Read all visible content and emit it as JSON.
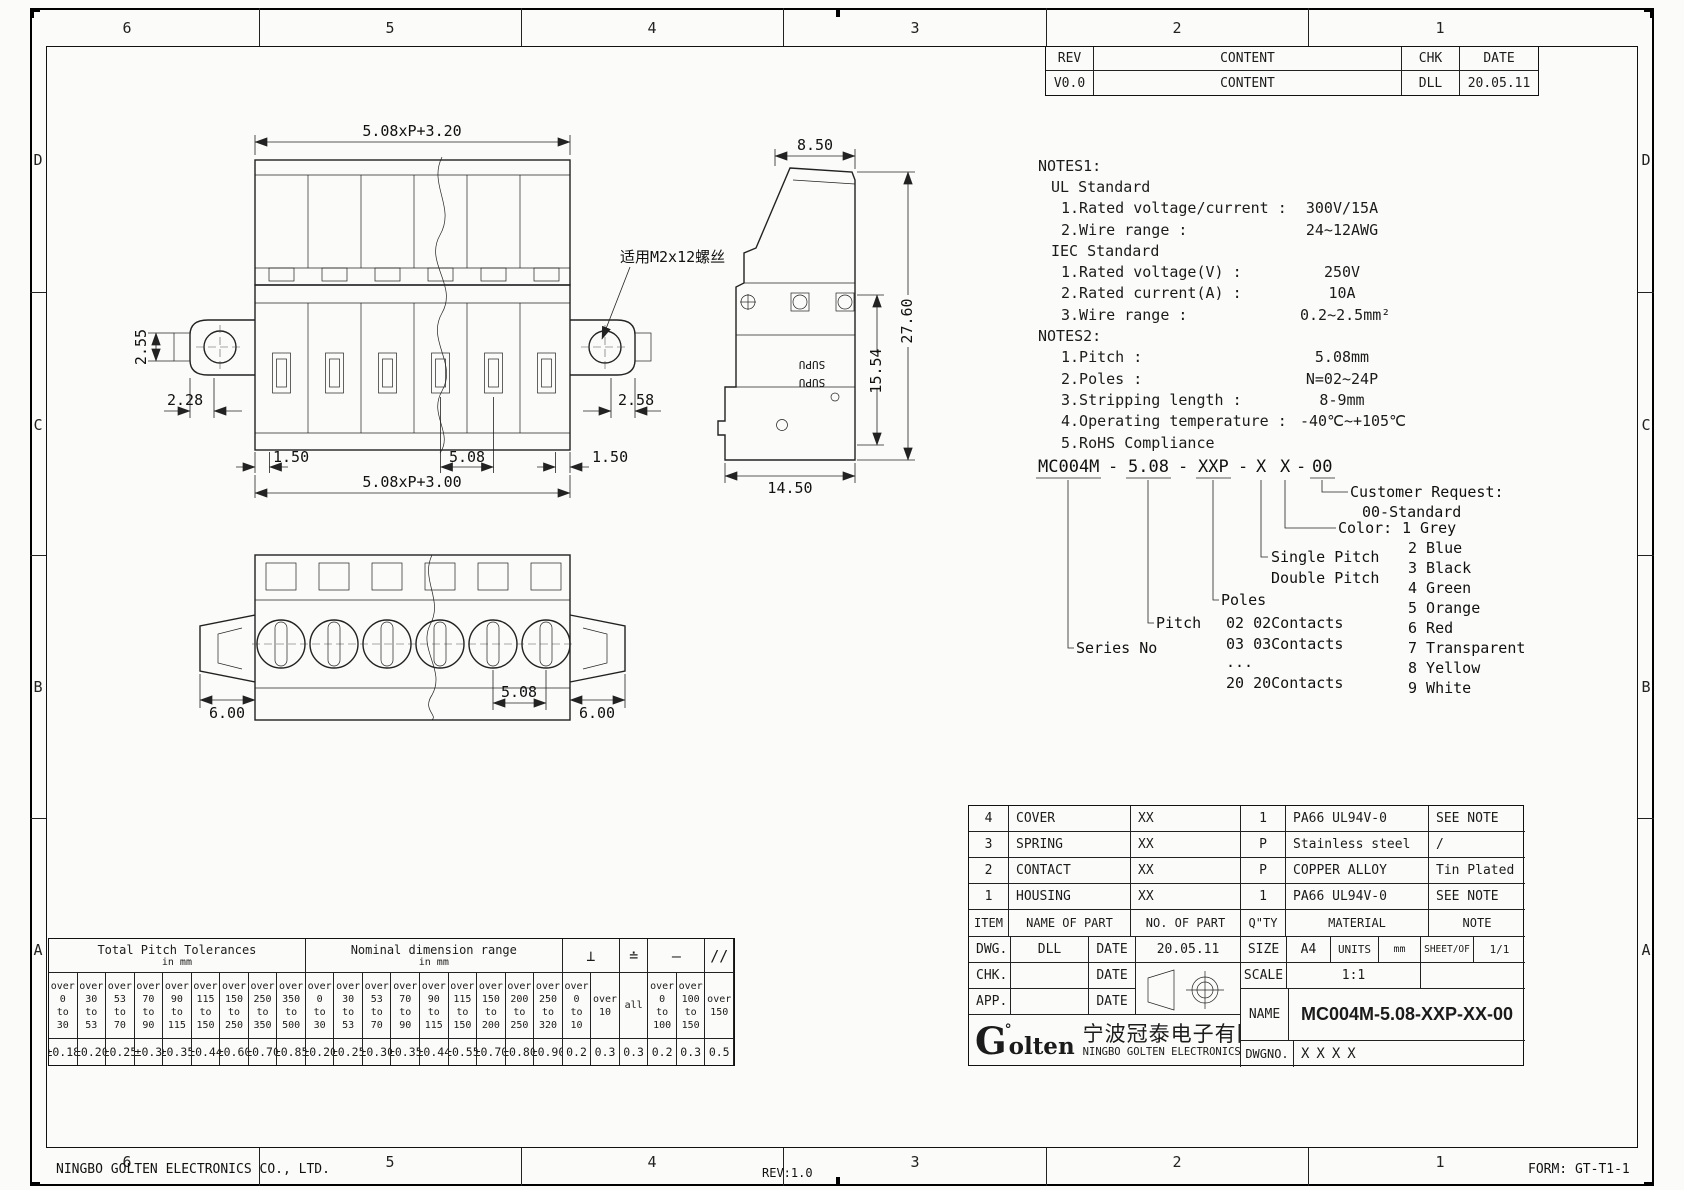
{
  "sheet": {
    "zones_cols": [
      "6",
      "5",
      "4",
      "3",
      "2",
      "1"
    ],
    "zones_rows": [
      "D",
      "C",
      "B",
      "A"
    ],
    "footer_company": "NINGBO GOLTEN ELECTRONICS CO., LTD.",
    "footer_rev": "REV:1.0",
    "footer_form": "FORM: GT-T1-1"
  },
  "revision_table": {
    "col_rev": "REV",
    "col_content": "CONTENT",
    "col_chk": "CHK",
    "col_date": "DATE",
    "row_rev": "V0.0",
    "row_content": "CONTENT",
    "row_chk": "DLL",
    "row_date": "20.05.11"
  },
  "notes": {
    "title1": "NOTES1:",
    "ul_header": "UL Standard",
    "ul1_label": "1.Rated voltage/current :",
    "ul1_value": "300V/15A",
    "ul2_label": "2.Wire range :",
    "ul2_value": "24~12AWG",
    "iec_header": "IEC Standard",
    "iec1_label": "1.Rated voltage(V) :",
    "iec1_value": "250V",
    "iec2_label": "2.Rated current(A) :",
    "iec2_value": "10A",
    "iec3_label": "3.Wire range :",
    "iec3_value": "0.2~2.5mm²",
    "title2": "NOTES2:",
    "n2_1_label": "1.Pitch :",
    "n2_1_value": "5.08mm",
    "n2_2_label": "2.Poles :",
    "n2_2_value": "N=02~24P",
    "n2_3_label": "3.Stripping length :",
    "n2_3_value": "8-9mm",
    "n2_4_label": "4.Operating temperature :",
    "n2_4_value": "-40℃~+105℃",
    "n2_5_label": "5.RoHS Compliance"
  },
  "ordering": {
    "seg_series": "MC004M",
    "dash": "-",
    "seg_pitch": "5.08",
    "seg_poles": "XXP",
    "seg_x1": "X",
    "seg_x2": "X",
    "seg_custom": "00",
    "series_label": "Series No",
    "pitch_label": "Pitch",
    "poles_label": "Poles",
    "poles_items": [
      "02 02Contacts",
      "03 03Contacts",
      "...",
      "20 20Contacts"
    ],
    "x1_line1": "Single Pitch",
    "x1_line2": "Double Pitch",
    "color_label": "Color:",
    "color_first": "1 Grey",
    "colors": [
      "2 Blue",
      "3 Black",
      "4 Green",
      "5 Orange",
      "6 Red",
      "7 Transparent",
      "8 Yellow",
      "9 White"
    ],
    "customer_label": "Customer Request:",
    "customer_value": "00-Standard"
  },
  "parts_table": {
    "h_item": "ITEM",
    "h_name": "NAME OF PART",
    "h_no": "NO. OF PART",
    "h_qty": "Q\"TY",
    "h_mat": "MATERIAL",
    "h_note": "NOTE",
    "rows": [
      {
        "item": "4",
        "name": "COVER",
        "no": "XX",
        "qty": "1",
        "mat": "PA66 UL94V-0",
        "note": "SEE NOTE"
      },
      {
        "item": "3",
        "name": "SPRING",
        "no": "XX",
        "qty": "P",
        "mat": "Stainless steel",
        "note": "/"
      },
      {
        "item": "2",
        "name": "CONTACT",
        "no": "XX",
        "qty": "P",
        "mat": "COPPER ALLOY",
        "note": "Tin Plated"
      },
      {
        "item": "1",
        "name": "HOUSING",
        "no": "XX",
        "qty": "1",
        "mat": "PA66 UL94V-0",
        "note": "SEE NOTE"
      }
    ]
  },
  "title_block": {
    "dwg_label": "DWG.",
    "dwg_name": "DLL",
    "date_label": "DATE",
    "dwg_date": "20.05.11",
    "chk_label": "CHK.",
    "app_label": "APP.",
    "size_label": "SIZE",
    "size_value": "A4",
    "units_label": "UNITS",
    "units_value": "mm",
    "sheet_label": "SHEET/OF",
    "sheet_value": "1/1",
    "scale_label": "SCALE",
    "scale_value": "1:1",
    "name_label": "NAME",
    "name_value": "MC004M-5.08-XXP-XX-00",
    "dwgno_label": "DWGNO.",
    "dwgno_value": "XXXX",
    "logo_g": "G",
    "logo_mark": "°",
    "logo_rest": "olten",
    "company_cn": "宁波冠泰电子有限公司",
    "company_en": "NINGBO GOLTEN ELECTRONICS CO., LTD."
  },
  "tolerance_table": {
    "g1_title": "Total Pitch Tolerances",
    "g1_sub": "in mm",
    "g2_title": "Nominal dimension range",
    "g2_sub": "in mm",
    "sym_perp": "⊥",
    "sym_sym": "≐",
    "sym_flat": "—",
    "sym_par": "//",
    "g1": [
      {
        "range": "over\n0\nto\n30",
        "tol": "±0.18"
      },
      {
        "range": "over\n30\nto\n53",
        "tol": "±0.20"
      },
      {
        "range": "over\n53\nto\n70",
        "tol": "±0.25"
      },
      {
        "range": "over\n70\nto\n90",
        "tol": "±0.3"
      },
      {
        "range": "over\n90\nto\n115",
        "tol": "±0.35"
      },
      {
        "range": "over\n115\nto\n150",
        "tol": "±0.44"
      },
      {
        "range": "over\n150\nto\n250",
        "tol": "±0.60"
      },
      {
        "range": "over\n250\nto\n350",
        "tol": "±0.70"
      },
      {
        "range": "over\n350\nto\n500",
        "tol": "±0.85"
      }
    ],
    "g2": [
      {
        "range": "over\n0\nto\n30",
        "tol": "±0.20"
      },
      {
        "range": "over\n30\nto\n53",
        "tol": "±0.25"
      },
      {
        "range": "over\n53\nto\n70",
        "tol": "±0.30"
      },
      {
        "range": "over\n70\nto\n90",
        "tol": "±0.35"
      },
      {
        "range": "over\n90\nto\n115",
        "tol": "±0.44"
      },
      {
        "range": "over\n115\nto\n150",
        "tol": "±0.55"
      },
      {
        "range": "over\n150\nto\n200",
        "tol": "±0.70"
      },
      {
        "range": "over\n200\nto\n250",
        "tol": "±0.80"
      },
      {
        "range": "over\n250\nto\n320",
        "tol": "±0.90"
      }
    ],
    "g3": [
      {
        "range": "over\n0\nto\n10",
        "tol": "0.2"
      },
      {
        "range": "over\n10",
        "tol": "0.3"
      },
      {
        "range": "all",
        "tol": "0.3"
      },
      {
        "range": "over\n0\nto\n100",
        "tol": "0.2"
      },
      {
        "range": "over\n100\nto\n150",
        "tol": "0.3"
      },
      {
        "range": "over\n150",
        "tol": "0.5"
      }
    ]
  },
  "views": {
    "top": {
      "dim_cover": "5.08xP+3.20",
      "dim_255": "2.55",
      "dim_228": "2.28",
      "dim_258": "2.58",
      "dim_150a": "1.50",
      "dim_508": "5.08",
      "dim_150b": "1.50",
      "dim_body": "5.08xP+3.00",
      "screw_note": "适用M2x12螺丝"
    },
    "side": {
      "dim_850": "8.50",
      "dim_2760": "27.60",
      "dim_1554": "15.54",
      "dim_1450": "14.50",
      "brand": "SUPU"
    },
    "front": {
      "dim_6a": "6.00",
      "dim_508": "5.08",
      "dim_6b": "6.00"
    }
  }
}
